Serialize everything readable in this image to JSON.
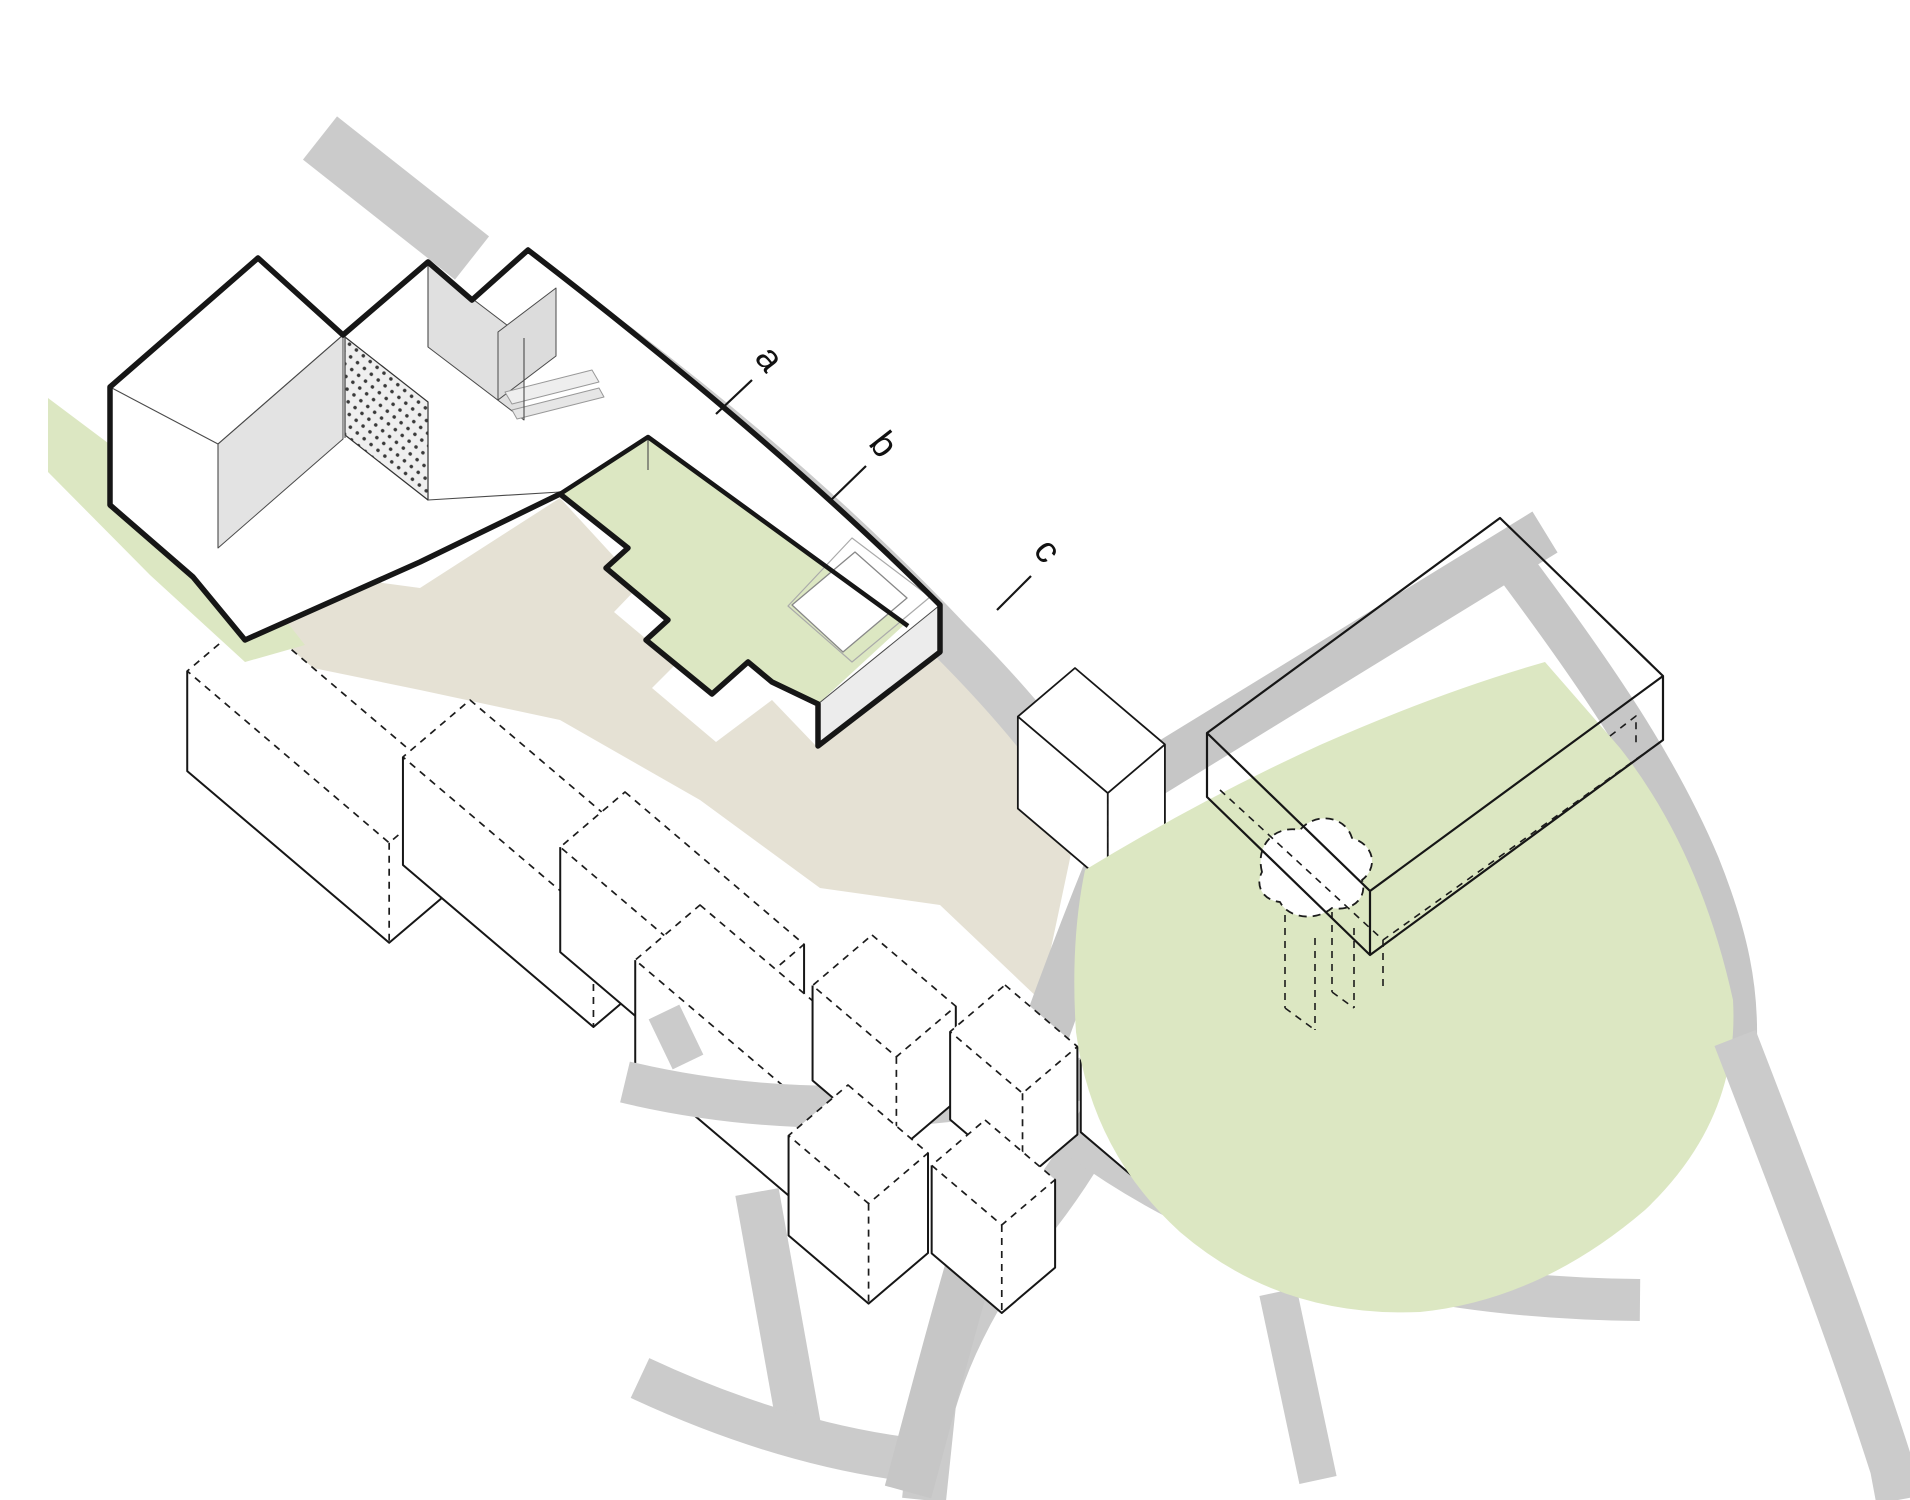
{
  "diagram": {
    "title": "axonometric site diagram",
    "labels": [
      {
        "id": "a",
        "text": "a",
        "x": 760,
        "y": 366,
        "rot": 52,
        "leader": {
          "x1": 716,
          "y1": 414,
          "x2": 752,
          "y2": 380
        }
      },
      {
        "id": "b",
        "text": "b",
        "x": 874,
        "y": 452,
        "rot": 52,
        "leader": {
          "x1": 831,
          "y1": 500,
          "x2": 866,
          "y2": 466
        }
      },
      {
        "id": "c",
        "text": "c",
        "x": 1038,
        "y": 558,
        "rot": 52,
        "leader": {
          "x1": 997,
          "y1": 610,
          "x2": 1031,
          "y2": 576
        }
      }
    ],
    "colors": {
      "background": "#ffffff",
      "road_gray": "#cbcbcb",
      "road_gray_dark": "#c6c6c6",
      "lawn_green": "#dce7c2",
      "shadow_beige": "#dbd5c3",
      "outline_black": "#161616",
      "thin_line": "#4a4a4a",
      "wall_gray": "#e3e3e3",
      "panel_gray": "#dcdcdc",
      "dash_line": "#1c1c1c"
    },
    "axes": {
      "rx": 0.762,
      "ry": 0.648,
      "lx": -0.762,
      "ly": 0.648
    },
    "shapes": [
      {
        "name": "road-north",
        "kind": "path",
        "d": "M320,138 L472,258",
        "stroke": "#cbcbcb",
        "sw": 55
      },
      {
        "name": "shadow-band",
        "kind": "polygon",
        "pts": [
          [
            118,
            458
          ],
          [
            250,
            565
          ],
          [
            420,
            588
          ],
          [
            560,
            498
          ],
          [
            640,
            585
          ],
          [
            614,
            612
          ],
          [
            676,
            664
          ],
          [
            652,
            688
          ],
          [
            716,
            742
          ],
          [
            772,
            700
          ],
          [
            818,
            748
          ],
          [
            940,
            655
          ],
          [
            1005,
            700
          ],
          [
            1075,
            835
          ],
          [
            1040,
            1000
          ],
          [
            940,
            905
          ],
          [
            820,
            888
          ],
          [
            700,
            800
          ],
          [
            560,
            720
          ],
          [
            420,
            690
          ],
          [
            250,
            655
          ],
          [
            118,
            540
          ]
        ],
        "fill": "#dbd5c3",
        "op": 0.72
      },
      {
        "name": "neighbor-bar-1",
        "kind": "prism",
        "T": [
          252,
          616
        ],
        "a": 265,
        "b": 85,
        "h": 100,
        "variant": "dashedTop"
      },
      {
        "name": "neighbor-bar-2",
        "kind": "prism",
        "T": [
          470,
          700
        ],
        "a": 250,
        "b": 88,
        "h": 108,
        "variant": "dashedTop"
      },
      {
        "name": "neighbor-bar-3",
        "kind": "prism",
        "T": [
          625,
          792
        ],
        "a": 235,
        "b": 85,
        "h": 105,
        "variant": "dashedTop"
      },
      {
        "name": "neighbor-bar-4",
        "kind": "prism",
        "T": [
          700,
          905
        ],
        "a": 230,
        "b": 85,
        "h": 105,
        "variant": "dashedTop"
      },
      {
        "name": "road-ne-sweep",
        "kind": "path",
        "d": "M538,286 Q775,455 950,640 Q1065,755 1122,862 Q1158,970 1126,1068 Q1082,1165 1018,1240 Q958,1322 934,1404 L924,1500",
        "stroke": "#cbcbcb",
        "sw": 44
      },
      {
        "name": "road-branch-left",
        "kind": "path",
        "d": "M625,1082 Q860,1138 1126,1068",
        "stroke": "#cbcbcb",
        "sw": 42
      },
      {
        "name": "road-stub-left",
        "kind": "path",
        "d": "M688,1062 L664,1012",
        "stroke": "#cbcbcb",
        "sw": 34
      },
      {
        "name": "road-branch-low",
        "kind": "path",
        "d": "M757,1192 L800,1432",
        "stroke": "#cbcbcb",
        "sw": 44
      },
      {
        "name": "road-cross-low",
        "kind": "path",
        "d": "M640,1378 Q790,1448 930,1462",
        "stroke": "#cbcbcb",
        "sw": 44
      },
      {
        "name": "big-building-fill",
        "kind": "polygon",
        "pts": [
          [
            1500,
            518
          ],
          [
            1663,
            676
          ],
          [
            1663,
            740
          ],
          [
            1370,
            955
          ],
          [
            1207,
            797
          ],
          [
            1207,
            733
          ]
        ],
        "fill": "#ffffff"
      },
      {
        "name": "road-long-diagonal",
        "kind": "path",
        "d": "M908,1492 C955,1320 1000,1120 1146,777 L1545,532",
        "stroke": "#c6c6c6",
        "sw": 48
      },
      {
        "name": "road-branch-right",
        "kind": "path",
        "d": "M1510,560 C1600,680 1660,770 1700,865 C1730,940 1738,990 1737,1040",
        "stroke": "#c6c6c6",
        "sw": 40
      },
      {
        "name": "road-under-green",
        "kind": "path",
        "d": "M1082,1140 C1240,1255 1430,1298 1640,1300",
        "stroke": "#cbcbcb",
        "sw": 42
      },
      {
        "name": "road-spur-bottom",
        "kind": "path",
        "d": "M1278,1292 L1318,1480",
        "stroke": "#cbcbcb",
        "sw": 38
      },
      {
        "name": "small-cube-1",
        "kind": "prism",
        "T": [
          872,
          935
        ],
        "a": 110,
        "b": 78,
        "h": 95,
        "variant": "dashedTop"
      },
      {
        "name": "small-cube-2",
        "kind": "prism",
        "T": [
          1005,
          985
        ],
        "a": 95,
        "b": 72,
        "h": 88,
        "variant": "dashedTop"
      },
      {
        "name": "small-cube-3",
        "kind": "prism",
        "T": [
          1128,
          1020
        ],
        "a": 80,
        "b": 62,
        "h": 72,
        "variant": "dashedTop"
      },
      {
        "name": "small-cube-4",
        "kind": "prism",
        "T": [
          848,
          1085
        ],
        "a": 105,
        "b": 78,
        "h": 100,
        "variant": "dashedTop"
      },
      {
        "name": "small-cube-5",
        "kind": "prism",
        "T": [
          985,
          1120
        ],
        "a": 92,
        "b": 70,
        "h": 88,
        "variant": "dashedTop"
      },
      {
        "name": "mid-building",
        "kind": "prism",
        "T": [
          1075,
          668
        ],
        "a": 118,
        "b": 75,
        "h": 92,
        "variant": "solid"
      },
      {
        "name": "green-meadow",
        "kind": "path",
        "d": "M1085,870 Q1200,800 1320,745 Q1440,692 1545,662 L1620,748 Q1700,850 1733,1000 Q1740,1120 1645,1210 Q1540,1300 1420,1312 Q1280,1318 1180,1232 Q1092,1152 1076,1032 Q1070,942 1085,870 Z",
        "fill": "#dce7c2"
      },
      {
        "name": "road-exit-corner",
        "kind": "path",
        "d": "M1735,1038 C1790,1180 1848,1330 1892,1468 L1898,1500",
        "stroke": "#cbcbcb",
        "sw": 44
      },
      {
        "name": "green-northwest",
        "kind": "polygon",
        "pts": [
          [
            48,
            398
          ],
          [
            120,
            452
          ],
          [
            250,
            575
          ],
          [
            305,
            645
          ],
          [
            245,
            662
          ],
          [
            150,
            575
          ],
          [
            48,
            472
          ]
        ],
        "fill": "#dce7c2"
      },
      {
        "name": "site-ground-fill",
        "kind": "path",
        "d": "M110,387 L258,258 L343,335 L428,262 L472,300 L528,250 Q775,440 940,605 L940,652 L818,746 L818,704 L772,682 L748,662 L712,694 L646,640 L668,620 L606,568 L628,548 L560,494 L420,562 L245,640 L193,577 L110,505 Z",
        "fill": "#ffffff"
      },
      {
        "name": "green-garden",
        "kind": "polygon",
        "pts": [
          [
            648,
            437
          ],
          [
            905,
            624
          ],
          [
            818,
            704
          ],
          [
            772,
            682
          ],
          [
            748,
            662
          ],
          [
            712,
            694
          ],
          [
            646,
            640
          ],
          [
            668,
            620
          ],
          [
            606,
            568
          ],
          [
            628,
            548
          ],
          [
            560,
            494
          ]
        ],
        "fill": "#dce7c2"
      },
      {
        "name": "plinth-wall-face",
        "kind": "polygon",
        "pts": [
          [
            940,
            605
          ],
          [
            940,
            652
          ],
          [
            818,
            746
          ],
          [
            818,
            704
          ]
        ],
        "fill": "#ececec",
        "stroke": "#4a4a4a",
        "sw": 1
      },
      {
        "name": "courtyard-wall-west",
        "kind": "polygon",
        "pts": [
          [
            343,
            335
          ],
          [
            218,
            444
          ],
          [
            218,
            548
          ],
          [
            343,
            439
          ]
        ],
        "fill": "#e3e3e3",
        "stroke": "#4a4a4a",
        "sw": 1
      },
      {
        "name": "courtyard-wall-north",
        "kind": "polygon",
        "pts": [
          [
            428,
            265
          ],
          [
            524,
            338
          ],
          [
            524,
            420
          ],
          [
            428,
            347
          ]
        ],
        "fill": "#e0e0e0",
        "stroke": "#4a4a4a",
        "sw": 1
      },
      {
        "name": "perforated-screen",
        "kind": "polygon",
        "pts": [
          [
            345,
            337
          ],
          [
            428,
            402
          ],
          [
            428,
            500
          ],
          [
            345,
            435
          ]
        ],
        "fill": "url(#dots)",
        "stroke": "#333333",
        "sw": 1.2
      },
      {
        "name": "courtyard-panel",
        "kind": "polygon",
        "pts": [
          [
            498,
            332
          ],
          [
            556,
            288
          ],
          [
            556,
            356
          ],
          [
            498,
            400
          ]
        ],
        "fill": "#dcdcdc",
        "stroke": "#4a4a4a",
        "sw": 1
      },
      {
        "name": "courtyard-bench-top",
        "kind": "polygon",
        "pts": [
          [
            505,
            392
          ],
          [
            592,
            370
          ],
          [
            599,
            382
          ],
          [
            512,
            404
          ]
        ],
        "fill": "#eeeeee",
        "stroke": "#999999",
        "sw": 1
      },
      {
        "name": "courtyard-bench-low",
        "kind": "polygon",
        "pts": [
          [
            512,
            410
          ],
          [
            599,
            388
          ],
          [
            604,
            397
          ],
          [
            517,
            419
          ]
        ],
        "fill": "#e6e6e6",
        "stroke": "#999999",
        "sw": 1
      },
      {
        "name": "roof-thin-lines",
        "kind": "path",
        "d": "M343,335 L218,444 L110,387 M218,444 L218,548 M345,337 L345,438 M428,265 L428,347 M524,338 L524,420 M428,500 L560,492 M648,437 L648,470",
        "stroke": "#4a4a4a",
        "sw": 1.1
      },
      {
        "name": "pavilion-ghost",
        "kind": "polygon",
        "pts": [
          [
            852,
            538
          ],
          [
            930,
            597
          ],
          [
            852,
            662
          ],
          [
            788,
            606
          ]
        ],
        "fill": "none",
        "stroke": "#aaaaaa",
        "sw": 1.2
      },
      {
        "name": "pavilion-roof",
        "kind": "polygon",
        "pts": [
          [
            855,
            552
          ],
          [
            907,
            598
          ],
          [
            843,
            652
          ],
          [
            792,
            605
          ]
        ],
        "fill": "#ffffff",
        "stroke": "#888888",
        "sw": 1.3
      },
      {
        "name": "organic-dashed-outline",
        "kind": "path",
        "d": "M1262,872 C1255,845 1275,825 1300,830 C1315,812 1345,815 1352,838 C1375,845 1378,868 1362,880 C1368,898 1352,912 1332,908 C1315,922 1288,918 1280,902 C1262,900 1255,885 1262,872 Z",
        "stroke": "#1c1c1c",
        "sw": 1.8,
        "dash": [
          8,
          6
        ],
        "fill": "#ffffff"
      },
      {
        "name": "organic-dashed-piers",
        "kind": "path",
        "d": "M1285,915 L1285,1008 M1315,938 L1315,1030 M1285,1008 L1315,1030 M1332,912 L1332,992 M1354,928 L1354,1008 M1332,992 L1354,1008",
        "stroke": "#1c1c1c",
        "sw": 1.6,
        "dash": [
          7,
          6
        ]
      },
      {
        "name": "big-building-outline",
        "kind": "path",
        "d": "M1500,518 L1663,676 L1663,740 L1370,955 L1207,797 L1207,733 Z M1207,733 L1370,891 L1663,676 M1370,891 L1370,955",
        "stroke": "#161616",
        "sw": 2.2,
        "fill": "none"
      },
      {
        "name": "big-building-hidden",
        "kind": "path",
        "d": "M1220,790 L1383,940 L1656,745 M1383,940 L1383,990 M1610,736 L1636,716 L1636,748",
        "stroke": "#1c1c1c",
        "sw": 1.6,
        "dash": [
          7,
          6
        ]
      },
      {
        "name": "site-boundary",
        "kind": "path",
        "d": "M110,387 L258,258 L343,335 L428,262 L472,300 L528,250 Q775,440 940,605 L940,652 L818,746 L818,704 L772,682 L748,662 L712,694 L646,640 L668,620 L606,568 L628,548 L560,494 L420,562 L245,640 L193,577 L110,505 Z",
        "stroke": "#161616",
        "sw": 5.5,
        "fill": "none"
      },
      {
        "name": "site-inner-edge",
        "kind": "path",
        "d": "M560,494 L648,437 L908,626",
        "stroke": "#161616",
        "sw": 4.5,
        "fill": "none"
      }
    ]
  }
}
